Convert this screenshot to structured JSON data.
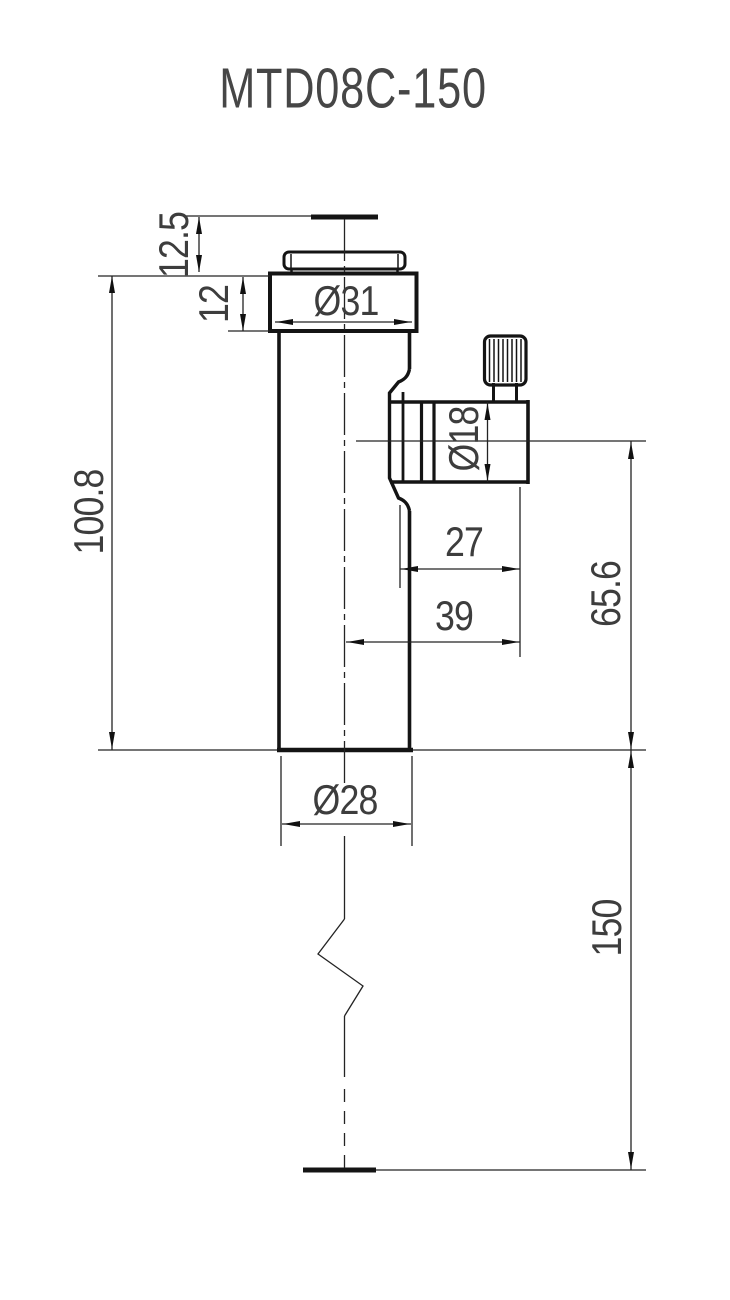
{
  "title": "MTD08C-150",
  "dimensions": {
    "top_plate_to_cap": "12.5",
    "cap_height": "12",
    "cap_diameter": "Ø31",
    "body_length": "100.8",
    "clamp_diameter": "Ø18",
    "clamp_face_to_relief": "27",
    "clamp_face_to_axis": "39",
    "clamp_axis_to_body_end": "65.6",
    "body_diameter": "Ø28",
    "post_length": "150"
  },
  "colors": {
    "outline": "#141414",
    "dimension_lines": "#232323",
    "text": "#3d3d3d",
    "background": "#ffffff"
  }
}
